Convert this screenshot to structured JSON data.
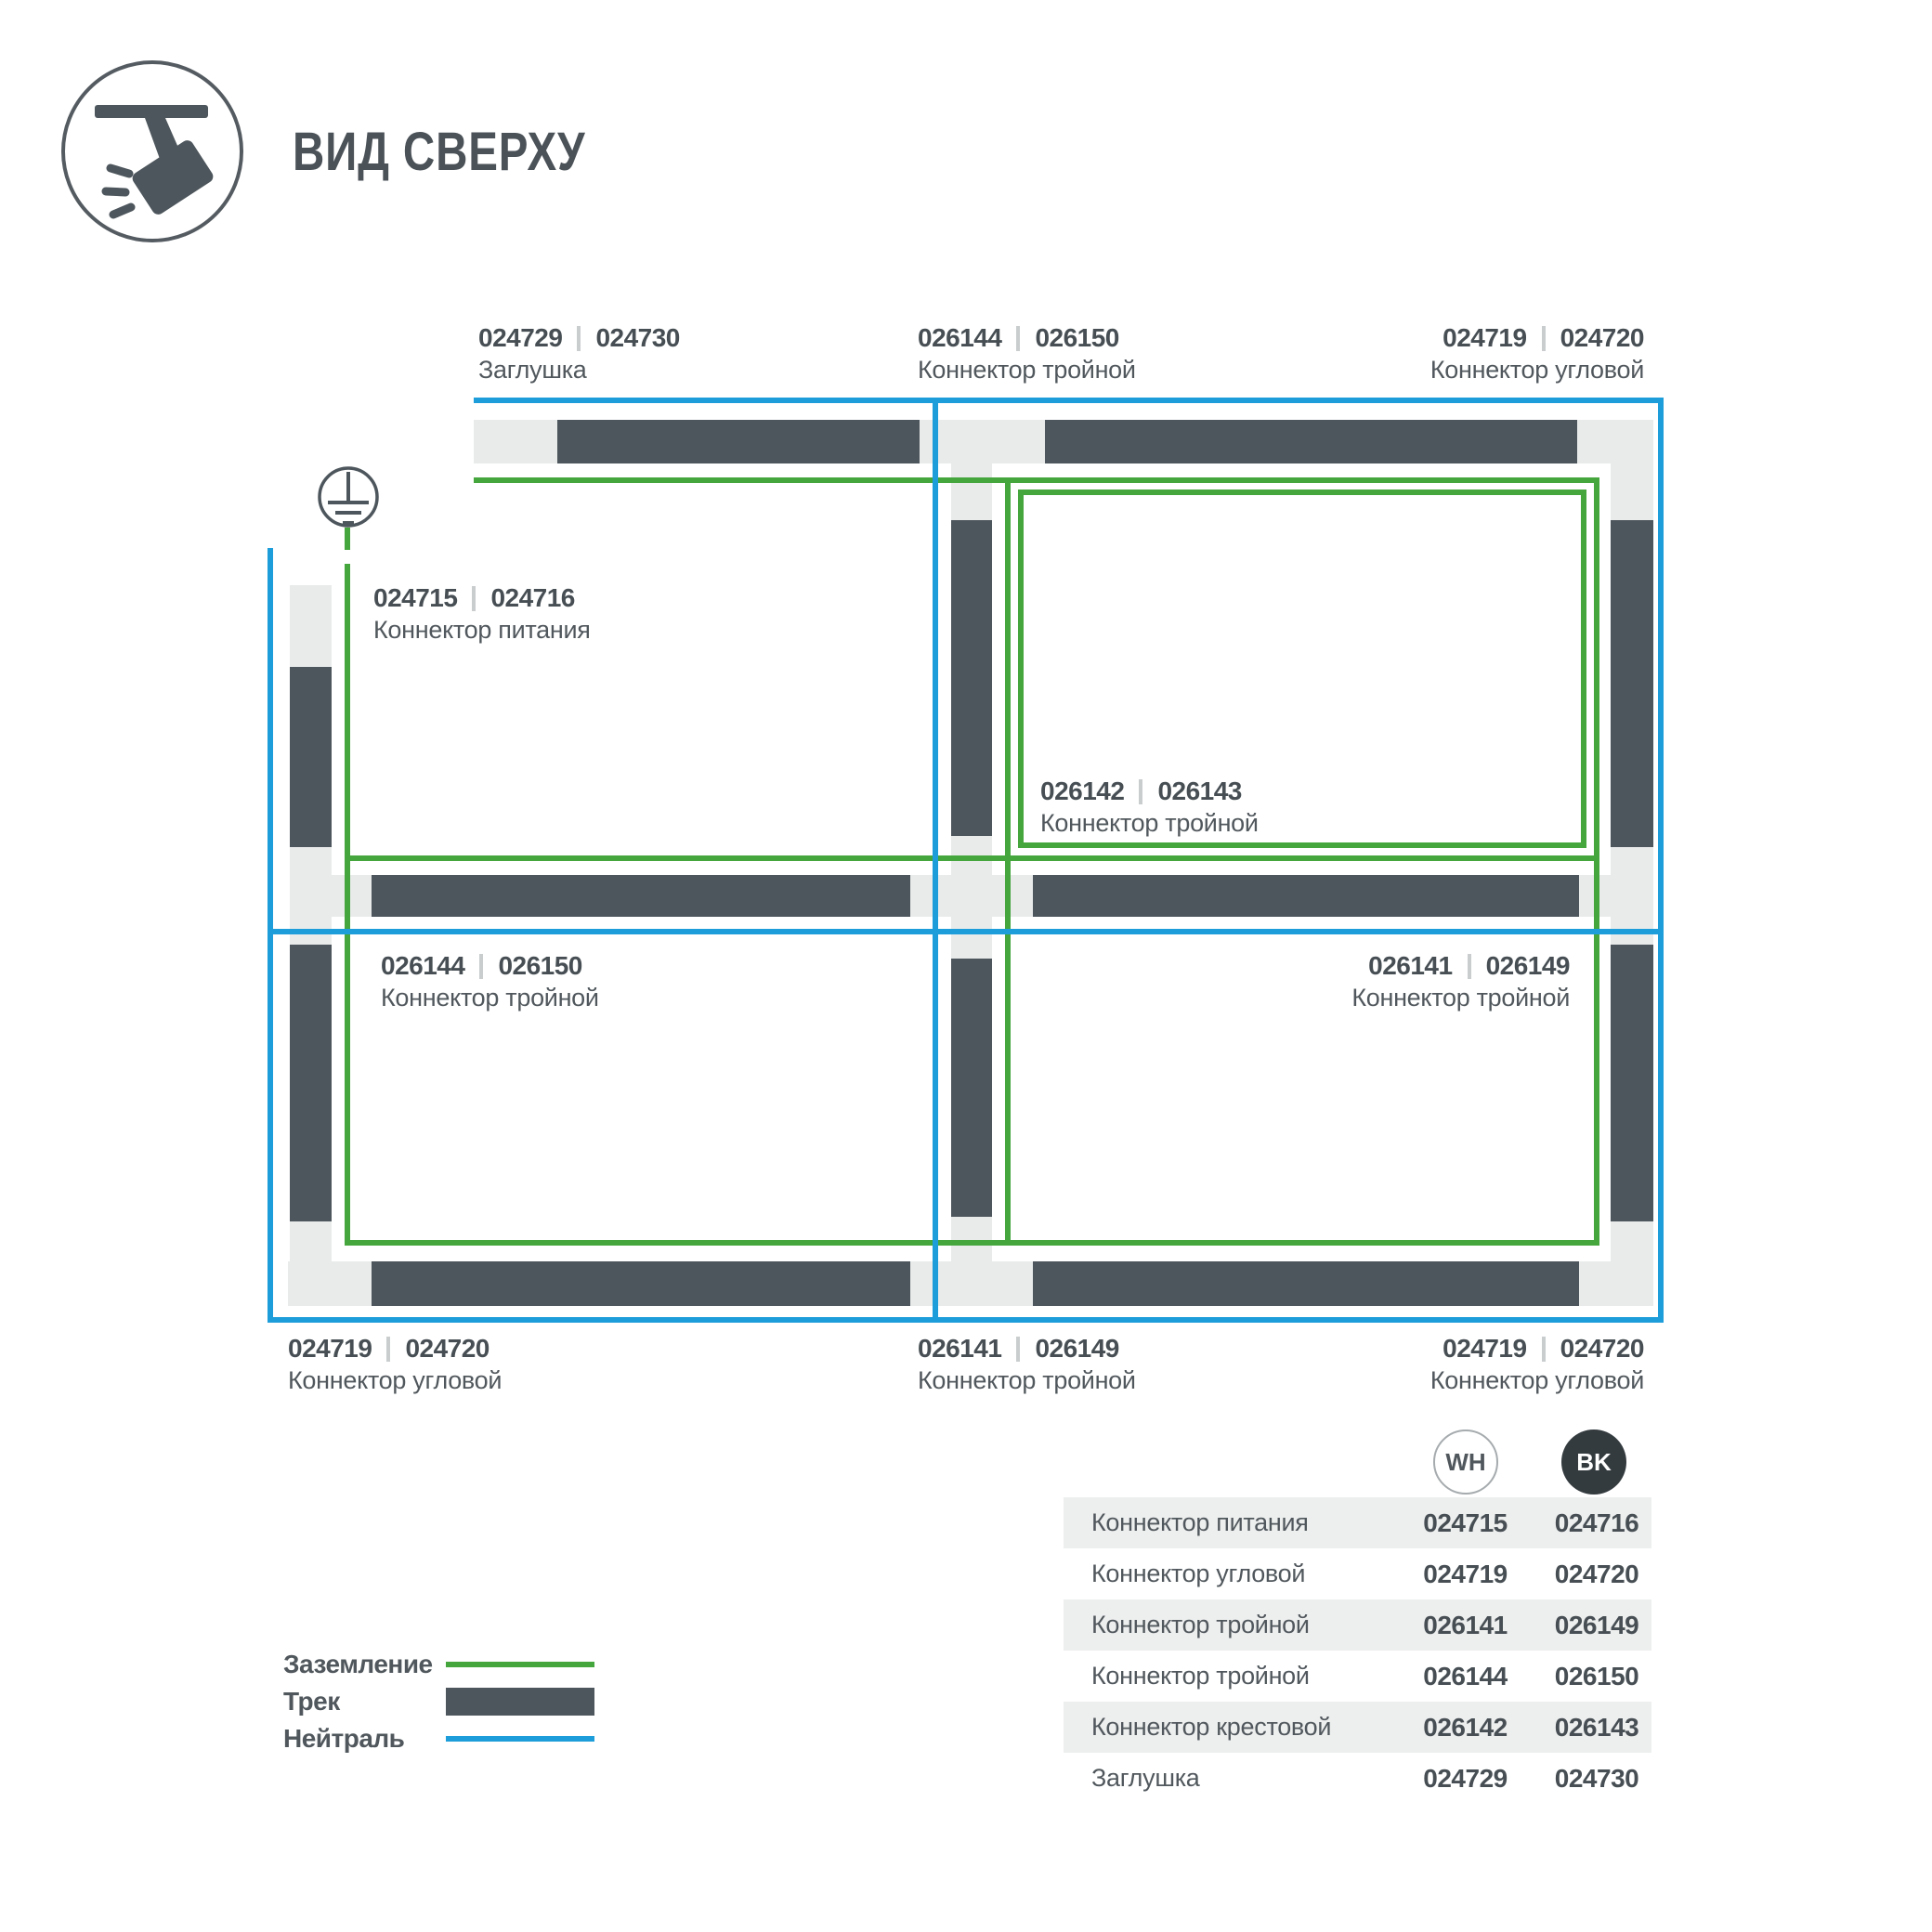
{
  "header": {
    "title": "ВИД СВЕРХУ"
  },
  "colors": {
    "green": "#44A63C",
    "blue": "#1D9DD9",
    "track": "#4D565C",
    "connector": "#E9EBEB",
    "text": "#51585D",
    "num": "#474F54",
    "sep": "#C9CDCE",
    "shade": "#EDEEEE",
    "bk": "#343B3F"
  },
  "diagram": {
    "labels": [
      {
        "wh": "024729",
        "bk": "024730",
        "name": "Заглушка"
      },
      {
        "wh": "026144",
        "bk": "026150",
        "name": "Коннектор тройной"
      },
      {
        "wh": "024719",
        "bk": "024720",
        "name": "Коннектор угловой"
      },
      {
        "wh": "024715",
        "bk": "024716",
        "name": "Коннектор питания"
      },
      {
        "wh": "026142",
        "bk": "026143",
        "name": "Коннектор тройной"
      },
      {
        "wh": "026144",
        "bk": "026150",
        "name": "Коннектор тройной"
      },
      {
        "wh": "026141",
        "bk": "026149",
        "name": "Коннектор тройной"
      },
      {
        "wh": "024719",
        "bk": "024720",
        "name": "Коннектор угловой"
      },
      {
        "wh": "026141",
        "bk": "026149",
        "name": "Коннектор тройной"
      },
      {
        "wh": "024719",
        "bk": "024720",
        "name": "Коннектор угловой"
      }
    ]
  },
  "legend": {
    "items": [
      {
        "label": "Заземление"
      },
      {
        "label": "Трек"
      },
      {
        "label": "Нейтраль"
      }
    ]
  },
  "table": {
    "badges": {
      "wh": "WH",
      "bk": "BK"
    },
    "rows": [
      {
        "name": "Коннектор питания",
        "wh": "024715",
        "bk": "024716"
      },
      {
        "name": "Коннектор угловой",
        "wh": "024719",
        "bk": "024720"
      },
      {
        "name": "Коннектор тройной",
        "wh": "026141",
        "bk": "026149"
      },
      {
        "name": "Коннектор тройной",
        "wh": "026144",
        "bk": "026150"
      },
      {
        "name": "Коннектор крестовой",
        "wh": "026142",
        "bk": "026143"
      },
      {
        "name": "Заглушка",
        "wh": "024729",
        "bk": "024730"
      }
    ]
  }
}
